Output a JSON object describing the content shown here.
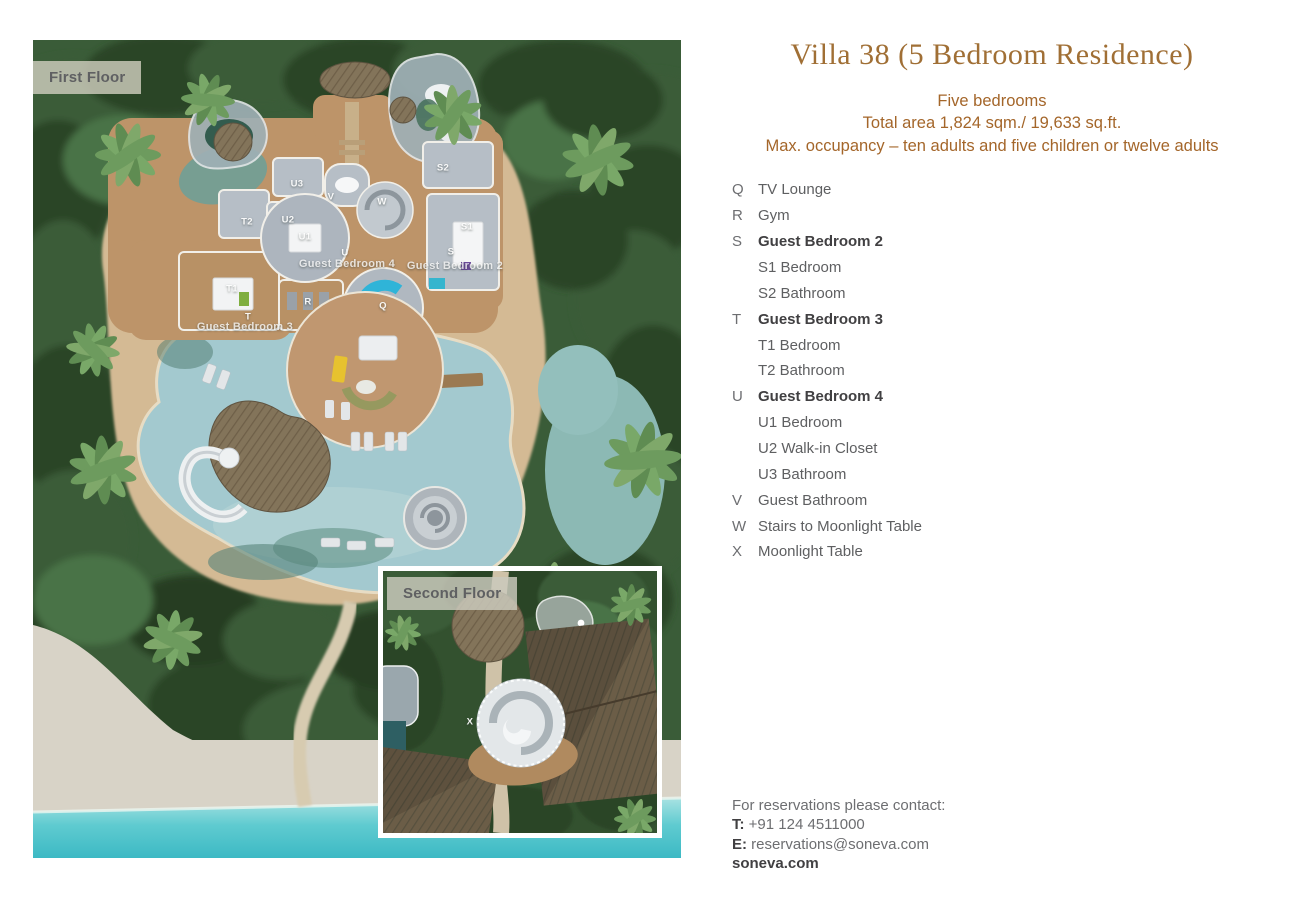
{
  "floor_plan": {
    "first_floor_label": "First Floor",
    "second_floor_label": "Second Floor",
    "room_labels": [
      {
        "text": "U3",
        "x": 264,
        "y": 144
      },
      {
        "text": "V",
        "x": 298,
        "y": 157
      },
      {
        "text": "U2",
        "x": 255,
        "y": 180
      },
      {
        "text": "U1",
        "x": 272,
        "y": 197
      },
      {
        "text": "U",
        "x": 312,
        "y": 213
      },
      {
        "text": "Guest Bedroom 4",
        "x": 314,
        "y": 224,
        "big": true
      },
      {
        "text": "S2",
        "x": 410,
        "y": 128
      },
      {
        "text": "S1",
        "x": 434,
        "y": 187
      },
      {
        "text": "S",
        "x": 418,
        "y": 212
      },
      {
        "text": "Guest Bedroom 2",
        "x": 422,
        "y": 226,
        "big": true
      },
      {
        "text": "T2",
        "x": 214,
        "y": 182
      },
      {
        "text": "T1",
        "x": 199,
        "y": 249
      },
      {
        "text": "T",
        "x": 215,
        "y": 277
      },
      {
        "text": "Guest Bedroom 3",
        "x": 212,
        "y": 287,
        "big": true
      },
      {
        "text": "R",
        "x": 275,
        "y": 262
      },
      {
        "text": "Q",
        "x": 350,
        "y": 266
      },
      {
        "text": "W",
        "x": 349,
        "y": 162
      },
      {
        "text": "X",
        "x": 437,
        "y": 682
      }
    ]
  },
  "details": {
    "title": "Villa 38 (5 Bedroom Residence)",
    "subtitle_lines": [
      "Five bedrooms",
      "Total area 1,824 sqm./ 19,633 sq.ft.",
      "Max. occupancy – ten adults and five children or twelve adults"
    ],
    "legend": [
      {
        "key": "Q",
        "label": "TV Lounge"
      },
      {
        "key": "R",
        "label": "Gym"
      },
      {
        "key": "S",
        "label": "Guest Bedroom 2",
        "bold": true
      },
      {
        "key": "",
        "label": "S1 Bedroom"
      },
      {
        "key": "",
        "label": "S2 Bathroom"
      },
      {
        "key": "T",
        "label": "Guest Bedroom 3",
        "bold": true
      },
      {
        "key": "",
        "label": "T1 Bedroom"
      },
      {
        "key": "",
        "label": "T2 Bathroom"
      },
      {
        "key": "U",
        "label": "Guest Bedroom 4",
        "bold": true
      },
      {
        "key": "",
        "label": "U1 Bedroom"
      },
      {
        "key": "",
        "label": "U2 Walk-in Closet"
      },
      {
        "key": "",
        "label": "U3 Bathroom"
      },
      {
        "key": "V",
        "label": "Guest Bathroom"
      },
      {
        "key": "W",
        "label": "Stairs to Moonlight Table"
      },
      {
        "key": "X",
        "label": "Moonlight Table"
      }
    ],
    "contact": {
      "heading": "For reservations please contact:",
      "phone_label": "T:",
      "phone": "+91 124 4511000",
      "email_label": "E:",
      "email": "reservations@soneva.com",
      "website": "soneva.com"
    }
  },
  "colors": {
    "title_brown": "#a06f35",
    "subtitle_brown": "#a4662a",
    "text_gray": "#6d6e71",
    "text_dark": "#414042",
    "ocean": "#49c2ca",
    "pool": "#a3c9cf",
    "beach_sand": "#d8d3c7",
    "clearing_sand": "#d4ba94",
    "foliage": "#3a5c38",
    "deck_wood": "#bd9469"
  }
}
